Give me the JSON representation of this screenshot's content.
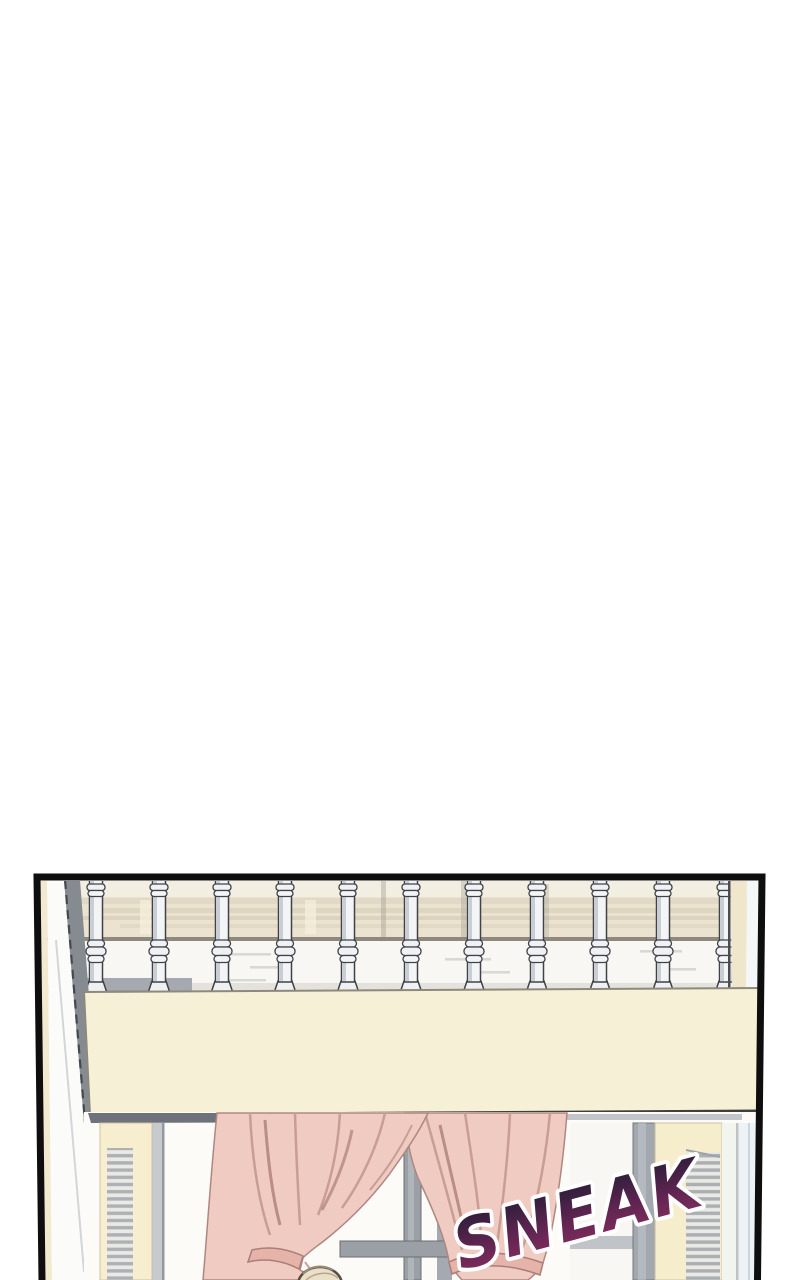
{
  "page": {
    "background": "#ffffff"
  },
  "panel": {
    "kind": "webtoon-comic-panel",
    "border_color": "#0e0e0e",
    "sfx": {
      "text": "SNEAK",
      "rotation_deg": -15,
      "outline_color": "#ffffff",
      "gradient_top": "#211d33",
      "gradient_mid": "#5c2450",
      "gradient_bottom": "#8e2f63"
    },
    "scene": {
      "railing_baluster_count": 11,
      "baluster_color": "#f3f4f6",
      "baluster_outline": "#3f4247",
      "background_band_color": "#ebe3cf",
      "background_rail_line": "#8f897d",
      "beam_color": "#f5f0d6",
      "curtain_color": "#f0cbc2",
      "curtain_fold_color": "#c89d94",
      "curtain_tie_color": "#e5b3a9",
      "window_frame_color": "#9aa0a6",
      "window_pane_color": "#f8f7f4",
      "shutter_frame_color": "#f6edcb",
      "shutter_louver_color": "#9aa0a6",
      "right_wall_color": "#edf2f6",
      "head_color": "#ebdfc8"
    }
  }
}
